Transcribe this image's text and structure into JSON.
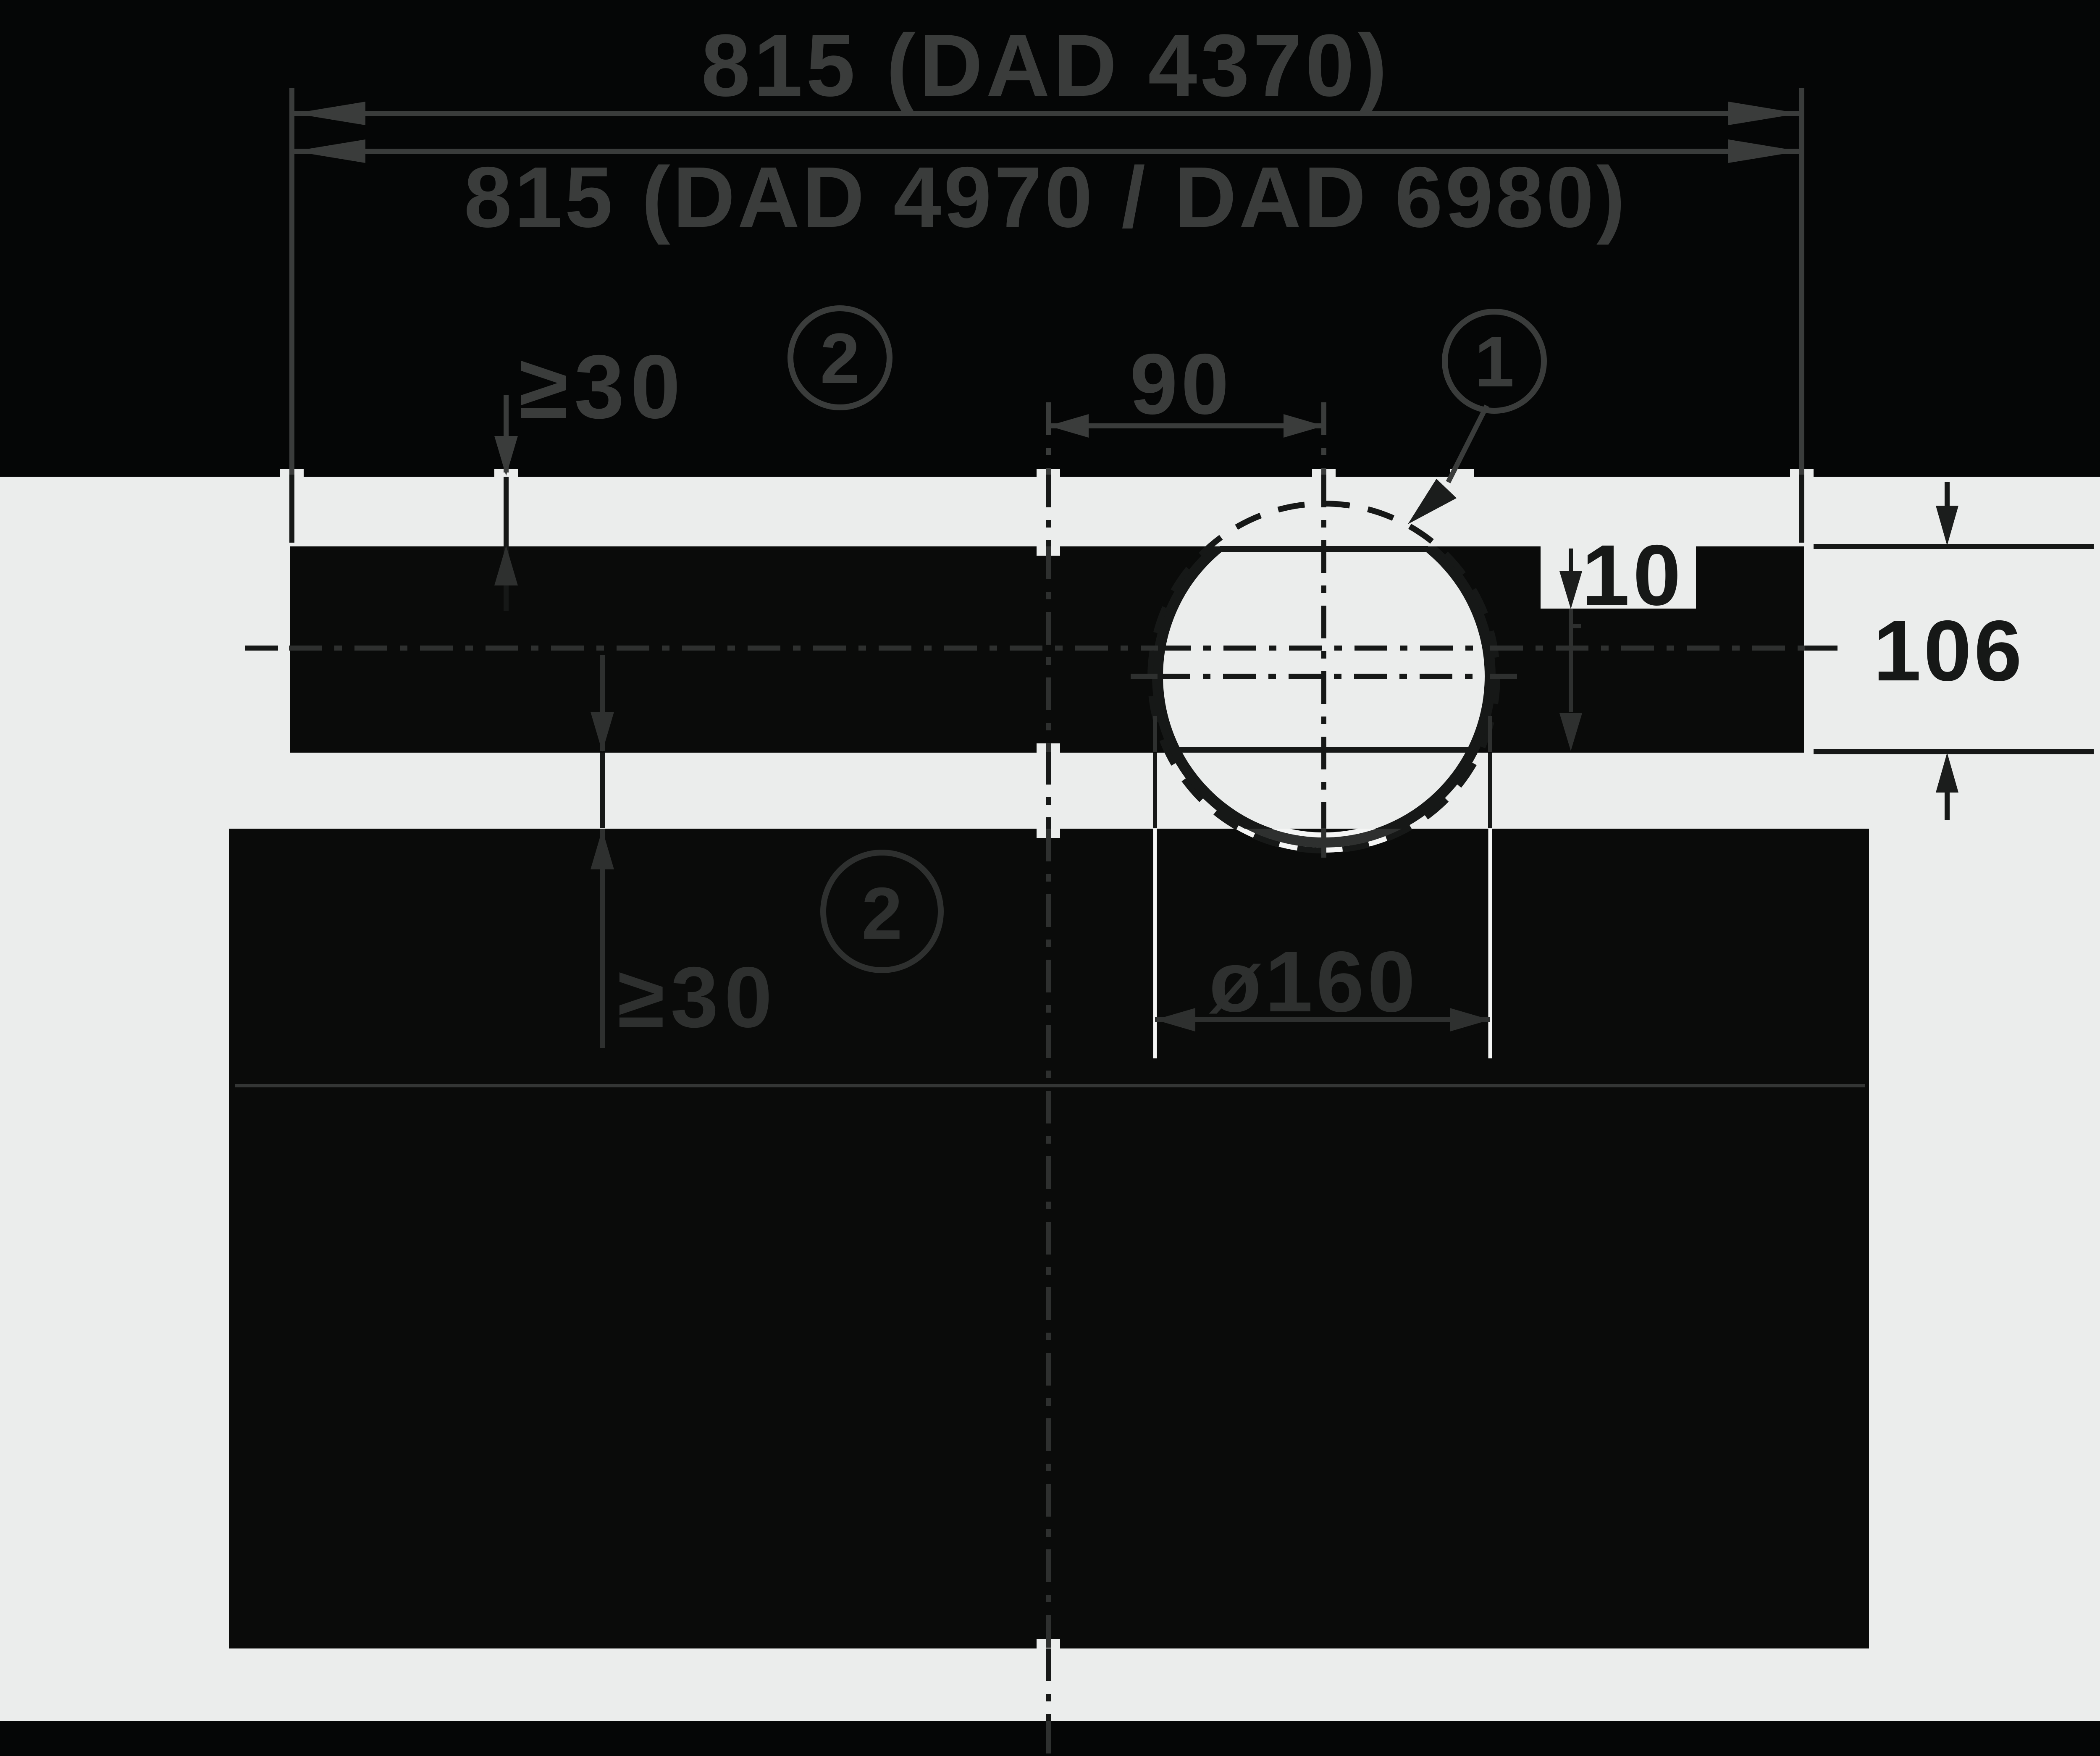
{
  "drawing": {
    "type": "installation-dimension-diagram",
    "width_models_a": {
      "label": "815 (DAD 4370)"
    },
    "width_models_b": {
      "label": "815 (DAD 4970 / DAD 6980)"
    },
    "clearance_top": {
      "label": "≥30",
      "note": "2"
    },
    "hole_offset": {
      "label": "90"
    },
    "callout": {
      "note": "1"
    },
    "edge_offset": {
      "label": "10"
    },
    "body_height": {
      "label": "106"
    },
    "clearance_below": {
      "label": "≥30",
      "note": "2"
    },
    "hole_diameter": {
      "label": "ø160"
    },
    "colors": {
      "background": "#050606",
      "panel_gray": "#ebedec",
      "dark_fill": "#0a0b0a",
      "ink": "#161817",
      "ghost_ink": "#3a3c3b",
      "white_casing": "#f4f5f4"
    }
  }
}
